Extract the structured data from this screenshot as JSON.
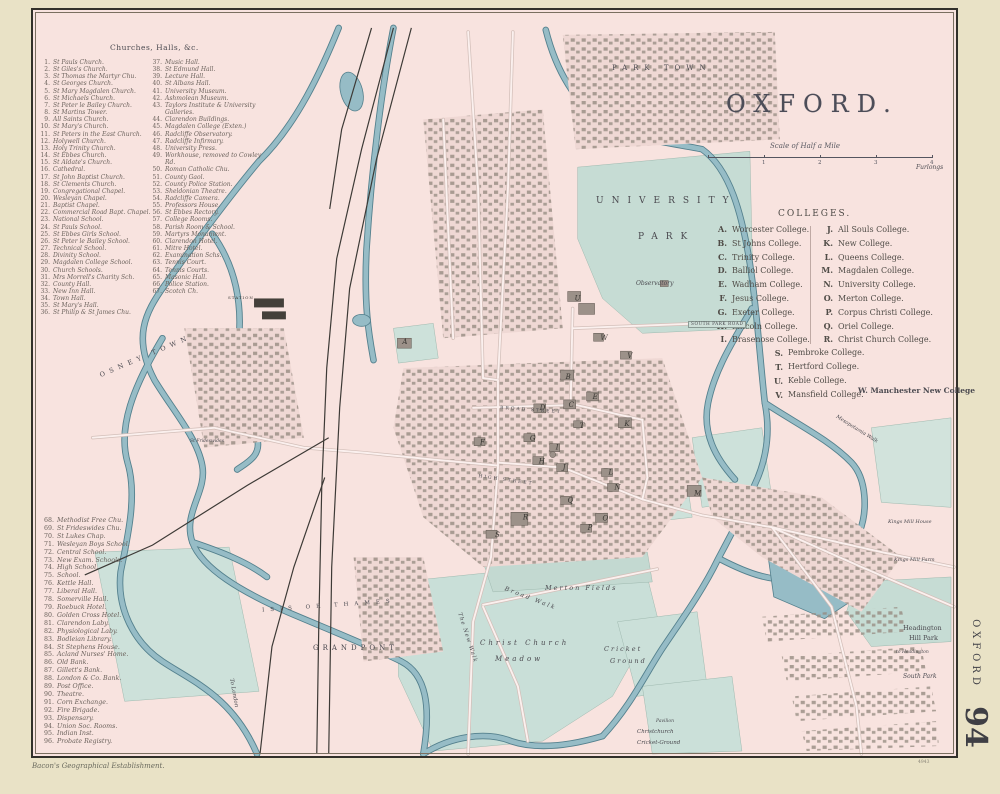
{
  "title": "OXFORD.",
  "scale": {
    "caption": "Scale of Half a Mile",
    "ticks": [
      "1",
      "2",
      "3",
      "4"
    ],
    "unit": "Furlongs"
  },
  "margin": {
    "vertical_title": "OXFORD",
    "plate_number": "94"
  },
  "imprint": "Bacon's Geographical Establishment.",
  "plate_code": "4943",
  "colleges": {
    "heading": "COLLEGES.",
    "col1": [
      {
        "n": "A.",
        "t": "Worcester College."
      },
      {
        "n": "B.",
        "t": "St Johns College."
      },
      {
        "n": "C.",
        "t": "Trinity College."
      },
      {
        "n": "D.",
        "t": "Balliol College."
      },
      {
        "n": "E.",
        "t": "Wadham College."
      },
      {
        "n": "F.",
        "t": "Jesus College."
      },
      {
        "n": "G.",
        "t": "Exeter College."
      },
      {
        "n": "H.",
        "t": "Lincoln College."
      },
      {
        "n": "I.",
        "t": "Brasenose College."
      }
    ],
    "col2": [
      {
        "n": "J.",
        "t": "All Souls College."
      },
      {
        "n": "K.",
        "t": "New College."
      },
      {
        "n": "L.",
        "t": "Queens College."
      },
      {
        "n": "M.",
        "t": "Magdalen College."
      },
      {
        "n": "N.",
        "t": "University College."
      },
      {
        "n": "O.",
        "t": "Merton College."
      },
      {
        "n": "P.",
        "t": "Corpus Christi College."
      },
      {
        "n": "Q.",
        "t": "Oriel College."
      },
      {
        "n": "R.",
        "t": "Christ Church College."
      }
    ],
    "col3": [
      {
        "n": "S.",
        "t": "Pembroke College."
      },
      {
        "n": "T.",
        "t": "Hertford College."
      },
      {
        "n": "U.",
        "t": "Keble College."
      },
      {
        "n": "V.",
        "t": "Mansfield College."
      }
    ],
    "w_item": "W. Manchester New College"
  },
  "churches": {
    "heading": "Churches, Halls, &c.",
    "col1": [
      {
        "n": "1.",
        "t": "St Pauls Church."
      },
      {
        "n": "2.",
        "t": "St Giles's Church."
      },
      {
        "n": "3.",
        "t": "St Thomas the Martyr Chu."
      },
      {
        "n": "4.",
        "t": "St Georges Church."
      },
      {
        "n": "5.",
        "t": "St Mary Magdalen Church."
      },
      {
        "n": "6.",
        "t": "St Michaels Church."
      },
      {
        "n": "7.",
        "t": "St Peter le Bailey Church."
      },
      {
        "n": "8.",
        "t": "St Martins Tower."
      },
      {
        "n": "9.",
        "t": "All Saints Church."
      },
      {
        "n": "10.",
        "t": "St Mary's Church."
      },
      {
        "n": "11.",
        "t": "St Peters in the East Church."
      },
      {
        "n": "12.",
        "t": "Holywell Church."
      },
      {
        "n": "13.",
        "t": "Holy Trinity Church."
      },
      {
        "n": "14.",
        "t": "St Ebbes Church."
      },
      {
        "n": "15.",
        "t": "St Aldate's Church."
      },
      {
        "n": "16.",
        "t": "Cathedral."
      },
      {
        "n": "17.",
        "t": "St John Baptist Church."
      },
      {
        "n": "18.",
        "t": "St Clements Church."
      },
      {
        "n": "19.",
        "t": "Congregational Chapel."
      },
      {
        "n": "20.",
        "t": "Wesleyan Chapel."
      },
      {
        "n": "21.",
        "t": "Baptist Chapel."
      },
      {
        "n": "22.",
        "t": "Commercial Road Bapt. Chapel."
      },
      {
        "n": "23.",
        "t": "National School."
      },
      {
        "n": "24.",
        "t": "St Pauls School."
      },
      {
        "n": "25.",
        "t": "St Ebbes Girls School."
      },
      {
        "n": "26.",
        "t": "St Peter le Bailey School."
      },
      {
        "n": "27.",
        "t": "Technical School."
      },
      {
        "n": "28.",
        "t": "Divinity School."
      },
      {
        "n": "29.",
        "t": "Magdalen College School."
      },
      {
        "n": "30.",
        "t": "Church Schools."
      },
      {
        "n": "31.",
        "t": "Mrs Morrell's Charity Sch."
      },
      {
        "n": "32.",
        "t": "County Hall."
      },
      {
        "n": "33.",
        "t": "New Inn Hall."
      },
      {
        "n": "34.",
        "t": "Town Hall."
      },
      {
        "n": "35.",
        "t": "St Mary's Hall."
      },
      {
        "n": "36.",
        "t": "St Philip & St James Chu."
      }
    ],
    "col2": [
      {
        "n": "37.",
        "t": "Music Hall."
      },
      {
        "n": "38.",
        "t": "St Edmund Hall."
      },
      {
        "n": "39.",
        "t": "Lecture Hall."
      },
      {
        "n": "40.",
        "t": "St Albans Hall."
      },
      {
        "n": "41.",
        "t": "University Museum."
      },
      {
        "n": "42.",
        "t": "Ashmolean Museum."
      },
      {
        "n": "43.",
        "t": "Taylors Institute & University Galleries."
      },
      {
        "n": "44.",
        "t": "Clarendon Buildings."
      },
      {
        "n": "45.",
        "t": "Magdalen College (Exten.)"
      },
      {
        "n": "46.",
        "t": "Radcliffe Observatory."
      },
      {
        "n": "47.",
        "t": "Radcliffe Infirmary."
      },
      {
        "n": "48.",
        "t": "University Press."
      },
      {
        "n": "49.",
        "t": "Workhouse, removed to Cowley Rd."
      },
      {
        "n": "50.",
        "t": "Roman Catholic Chu."
      },
      {
        "n": "51.",
        "t": "County Gaol."
      },
      {
        "n": "52.",
        "t": "County Police Station."
      },
      {
        "n": "53.",
        "t": "Sheldonian Theatre."
      },
      {
        "n": "54.",
        "t": "Radcliffe Camera."
      },
      {
        "n": "55.",
        "t": "Professors House."
      },
      {
        "n": "56.",
        "t": "St Ebbes Rectory."
      },
      {
        "n": "57.",
        "t": "College Rooms."
      },
      {
        "n": "58.",
        "t": "Parish Room & School."
      },
      {
        "n": "59.",
        "t": "Martyrs Monument."
      },
      {
        "n": "60.",
        "t": "Clarendon Hotel."
      },
      {
        "n": "61.",
        "t": "Mitre Hotel."
      },
      {
        "n": "62.",
        "t": "Examination Schs."
      },
      {
        "n": "63.",
        "t": "Tennis Court."
      },
      {
        "n": "64.",
        "t": "Tennis Courts."
      },
      {
        "n": "65.",
        "t": "Masonic Hall."
      },
      {
        "n": "66.",
        "t": "Police Station."
      },
      {
        "n": "67.",
        "t": "Scotch Ch."
      }
    ],
    "col3": [
      {
        "n": "68.",
        "t": "Methodist Free Chu."
      },
      {
        "n": "69.",
        "t": "St Frideswides Chu."
      },
      {
        "n": "70.",
        "t": "St Lukes Chap."
      },
      {
        "n": "71.",
        "t": "Wesleyan Boys School."
      },
      {
        "n": "72.",
        "t": "Central School."
      },
      {
        "n": "73.",
        "t": "New Exam. Schools."
      },
      {
        "n": "74.",
        "t": "High School."
      },
      {
        "n": "75.",
        "t": "School."
      },
      {
        "n": "76.",
        "t": "Kettle Hall."
      },
      {
        "n": "77.",
        "t": "Liberal Hall."
      },
      {
        "n": "78.",
        "t": "Somerville Hall."
      },
      {
        "n": "79.",
        "t": "Roebuck Hotel."
      },
      {
        "n": "80.",
        "t": "Golden Cross Hotel."
      },
      {
        "n": "81.",
        "t": "Clarendon Laby."
      },
      {
        "n": "82.",
        "t": "Physiological Laby."
      },
      {
        "n": "83.",
        "t": "Bodleian Library."
      },
      {
        "n": "84.",
        "t": "St Stephens House."
      },
      {
        "n": "85.",
        "t": "Acland Nurses' Home."
      },
      {
        "n": "86.",
        "t": "Old Bank."
      },
      {
        "n": "87.",
        "t": "Gillett's Bank."
      },
      {
        "n": "88.",
        "t": "London & Co. Bank."
      },
      {
        "n": "89.",
        "t": "Post Office."
      },
      {
        "n": "90.",
        "t": "Theatre."
      },
      {
        "n": "91.",
        "t": "Corn Exchange."
      },
      {
        "n": "92.",
        "t": "Fire Brigade."
      },
      {
        "n": "93.",
        "t": "Dispensary."
      },
      {
        "n": "94.",
        "t": "Union Soc. Rooms."
      },
      {
        "n": "95.",
        "t": "Indian Inst."
      },
      {
        "n": "96.",
        "t": "Probate Registry."
      }
    ]
  },
  "map": {
    "labels": {
      "park_town": "PARK TOWN",
      "university": "UNIVERSITY",
      "park": "PARK",
      "observatory": "Observatory",
      "south_park_road": "SOUTH PARK ROAD",
      "osney_town": "OSNEY TOWN",
      "grandpont": "GRANDPONT",
      "merton_fields": "Merton Fields",
      "broad_walk": "Broad Walk",
      "new_walk": "The New Walk",
      "christ_church": "Christ Church",
      "meadow": "Meadow",
      "cricket": "Cricket",
      "ground": "Ground",
      "christchurch": "Christchurch",
      "cricket_ground": "Cricket-Ground",
      "pavilion": "Pavilion",
      "headington": "Headington",
      "hill_park": "Hill Park",
      "to_headington": "to Headington",
      "south_park": "South Park",
      "kings_mill_house": "Kings Mill House",
      "kings_mill_farm": "Kings Mill Farm",
      "mesopotamia": "Mesopotamia Walk",
      "isis": "ISIS OR THAMES",
      "to_london": "To London",
      "broad_street": "BROAD STREET",
      "high_street": "HIGH STREET",
      "st_frideswides": "St Frideswides",
      "station": "STATION"
    },
    "markers": [
      "A",
      "B",
      "C",
      "D",
      "E",
      "F",
      "G",
      "H",
      "I",
      "J",
      "K",
      "L",
      "M",
      "N",
      "O",
      "P",
      "Q",
      "R",
      "S",
      "T",
      "U",
      "V",
      "W"
    ]
  }
}
